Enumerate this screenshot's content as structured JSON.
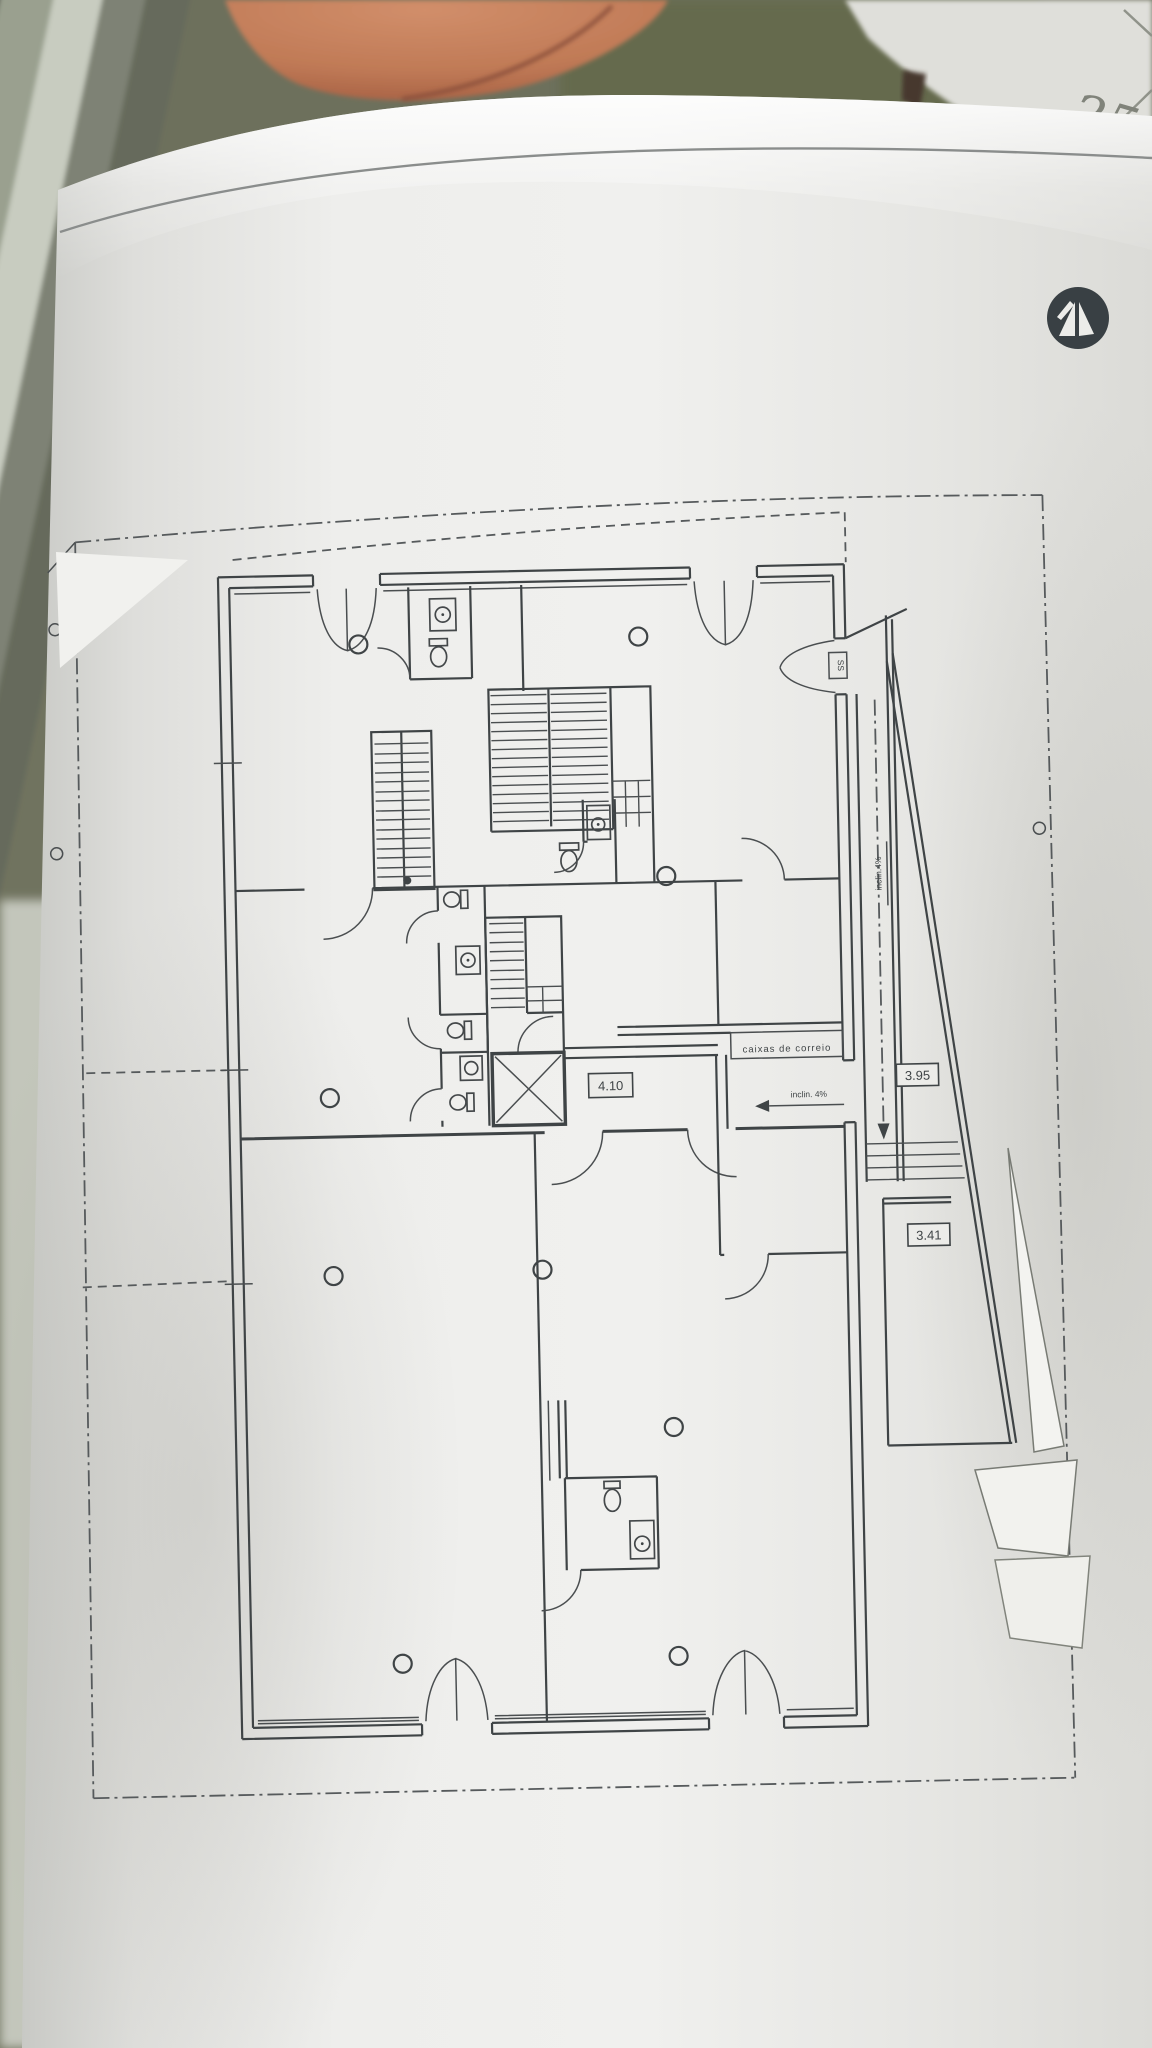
{
  "photo": {
    "handwritten_page_number": "25",
    "colors": {
      "background_olive": "#70735f",
      "terracotta_object": "#c08058",
      "paper": "#ecece9",
      "window_frame": "#9aa08f"
    }
  },
  "plan": {
    "labels": {
      "hall_width": "4.10",
      "ramp_width": "3.95",
      "lower_stair_width": "3.41",
      "mailboxes": "caixas  de  correio",
      "ramp_slope": "inclin. 4%",
      "ramp_slope_side": "inclin.4%",
      "entry_marker": "SS"
    },
    "colors": {
      "ink": "#3f4446",
      "boundary": "#565a5c"
    }
  },
  "logo": {
    "icon": "architect-stamp-triangular-monogram",
    "color": "#394044"
  }
}
